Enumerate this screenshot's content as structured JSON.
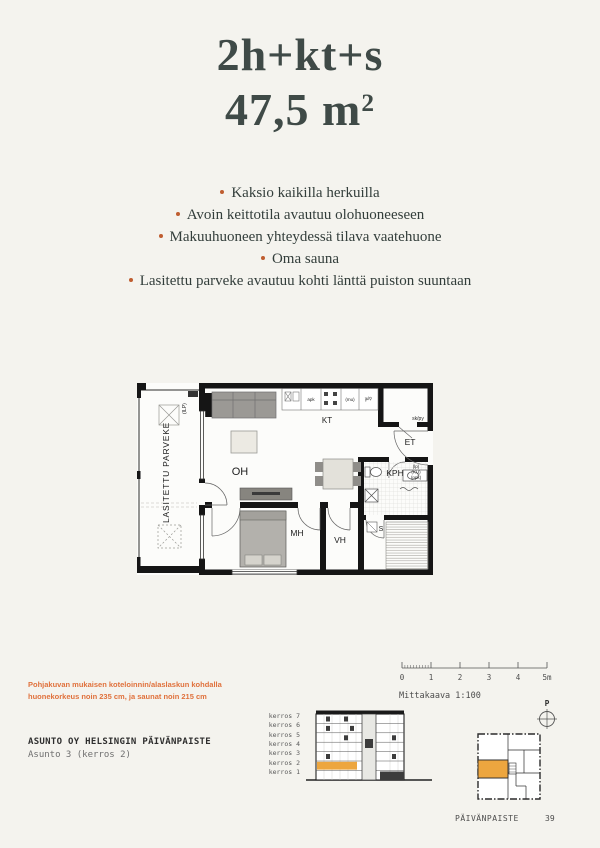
{
  "colors": {
    "page_bg": "#f4f3ee",
    "accent_orange": "#bf5d30",
    "footnote_orange": "#e0713c",
    "highlight_amber": "#eda63f",
    "title_text": "#3f4a47",
    "body_text": "#333e3b",
    "mono_text": "#4d4d4d"
  },
  "header": {
    "type_label": "2h+kt+s",
    "area_value": "47,5 m",
    "area_sup": "2"
  },
  "highlights": [
    "Kaksio kaikilla herkuilla",
    "Avoin keittotila avautuu olohuoneeseen",
    "Makuuhuoneen yhteydessä tilava vaatehuone",
    "Oma sauna",
    "Lasitettu parveke avautuu kohti länttä puiston suuntaan"
  ],
  "floorplan": {
    "rooms": {
      "balcony": "LASITETTU PARVEKE",
      "living_room": "OH",
      "kitchen": "KT",
      "hallway": "ET",
      "bathroom": "KPH",
      "bedroom": "MH",
      "walk_in_closet": "VH",
      "sauna": "S",
      "utility_closet": "sk/py",
      "heat_pump": "(ILP)"
    },
    "appliances": {
      "dishwasher": "apk",
      "microwave_reservation": "(mu)",
      "fridge_freezer": "jk/p",
      "floor_drain": "(lp)",
      "dryer_reservation": "(KU)",
      "washer_reservation": "(ppk)"
    }
  },
  "footnote": {
    "line1": "Pohjakuvan mukaisen koteloinnin/alaslaskun kohdalla",
    "line2": "huonekorkeus noin 235 cm, ja saunat noin 215 cm"
  },
  "project": {
    "company": "ASUNTO OY HELSINGIN PÄIVÄNPAISTE",
    "apartment": "Asunto 3 (kerros 2)"
  },
  "scale": {
    "label": "Mittakaava 1:100",
    "ticks": [
      "0",
      "1",
      "2",
      "3",
      "4",
      "5m"
    ]
  },
  "north": {
    "label": "P"
  },
  "building": {
    "floors": [
      "kerros 7",
      "kerros 6",
      "kerros 5",
      "kerros 4",
      "kerros 3",
      "kerros 2",
      "kerros 1"
    ],
    "highlighted_floor": "kerros 2"
  },
  "footer": {
    "project_name": "PÄIVÄNPAISTE",
    "page_number": "39"
  }
}
